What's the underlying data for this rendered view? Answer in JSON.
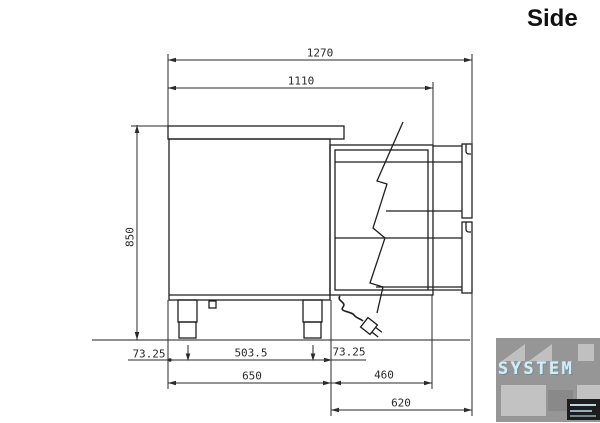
{
  "title": "Side",
  "drawing": {
    "dimensions": {
      "overall_depth": "1270",
      "depth_to_rear_panel": "1110",
      "height": "850",
      "front_leg_offset": "73.25",
      "leg_spacing": "503.5",
      "rear_leg_offset": "73.25",
      "body_depth": "650",
      "rear_section_depth": "460",
      "rear_unit_depth": "620"
    }
  },
  "watermark": {
    "brand": "SYSTEM"
  },
  "colors": {
    "line": "#1f1f1f",
    "dimension_line": "#2a2a2a",
    "dimension_text": "#2a2a2a",
    "background": "#ffffff",
    "watermark_background": "#969696",
    "watermark_light": "#c0c0c0",
    "watermark_text": "#d6ecf4"
  }
}
